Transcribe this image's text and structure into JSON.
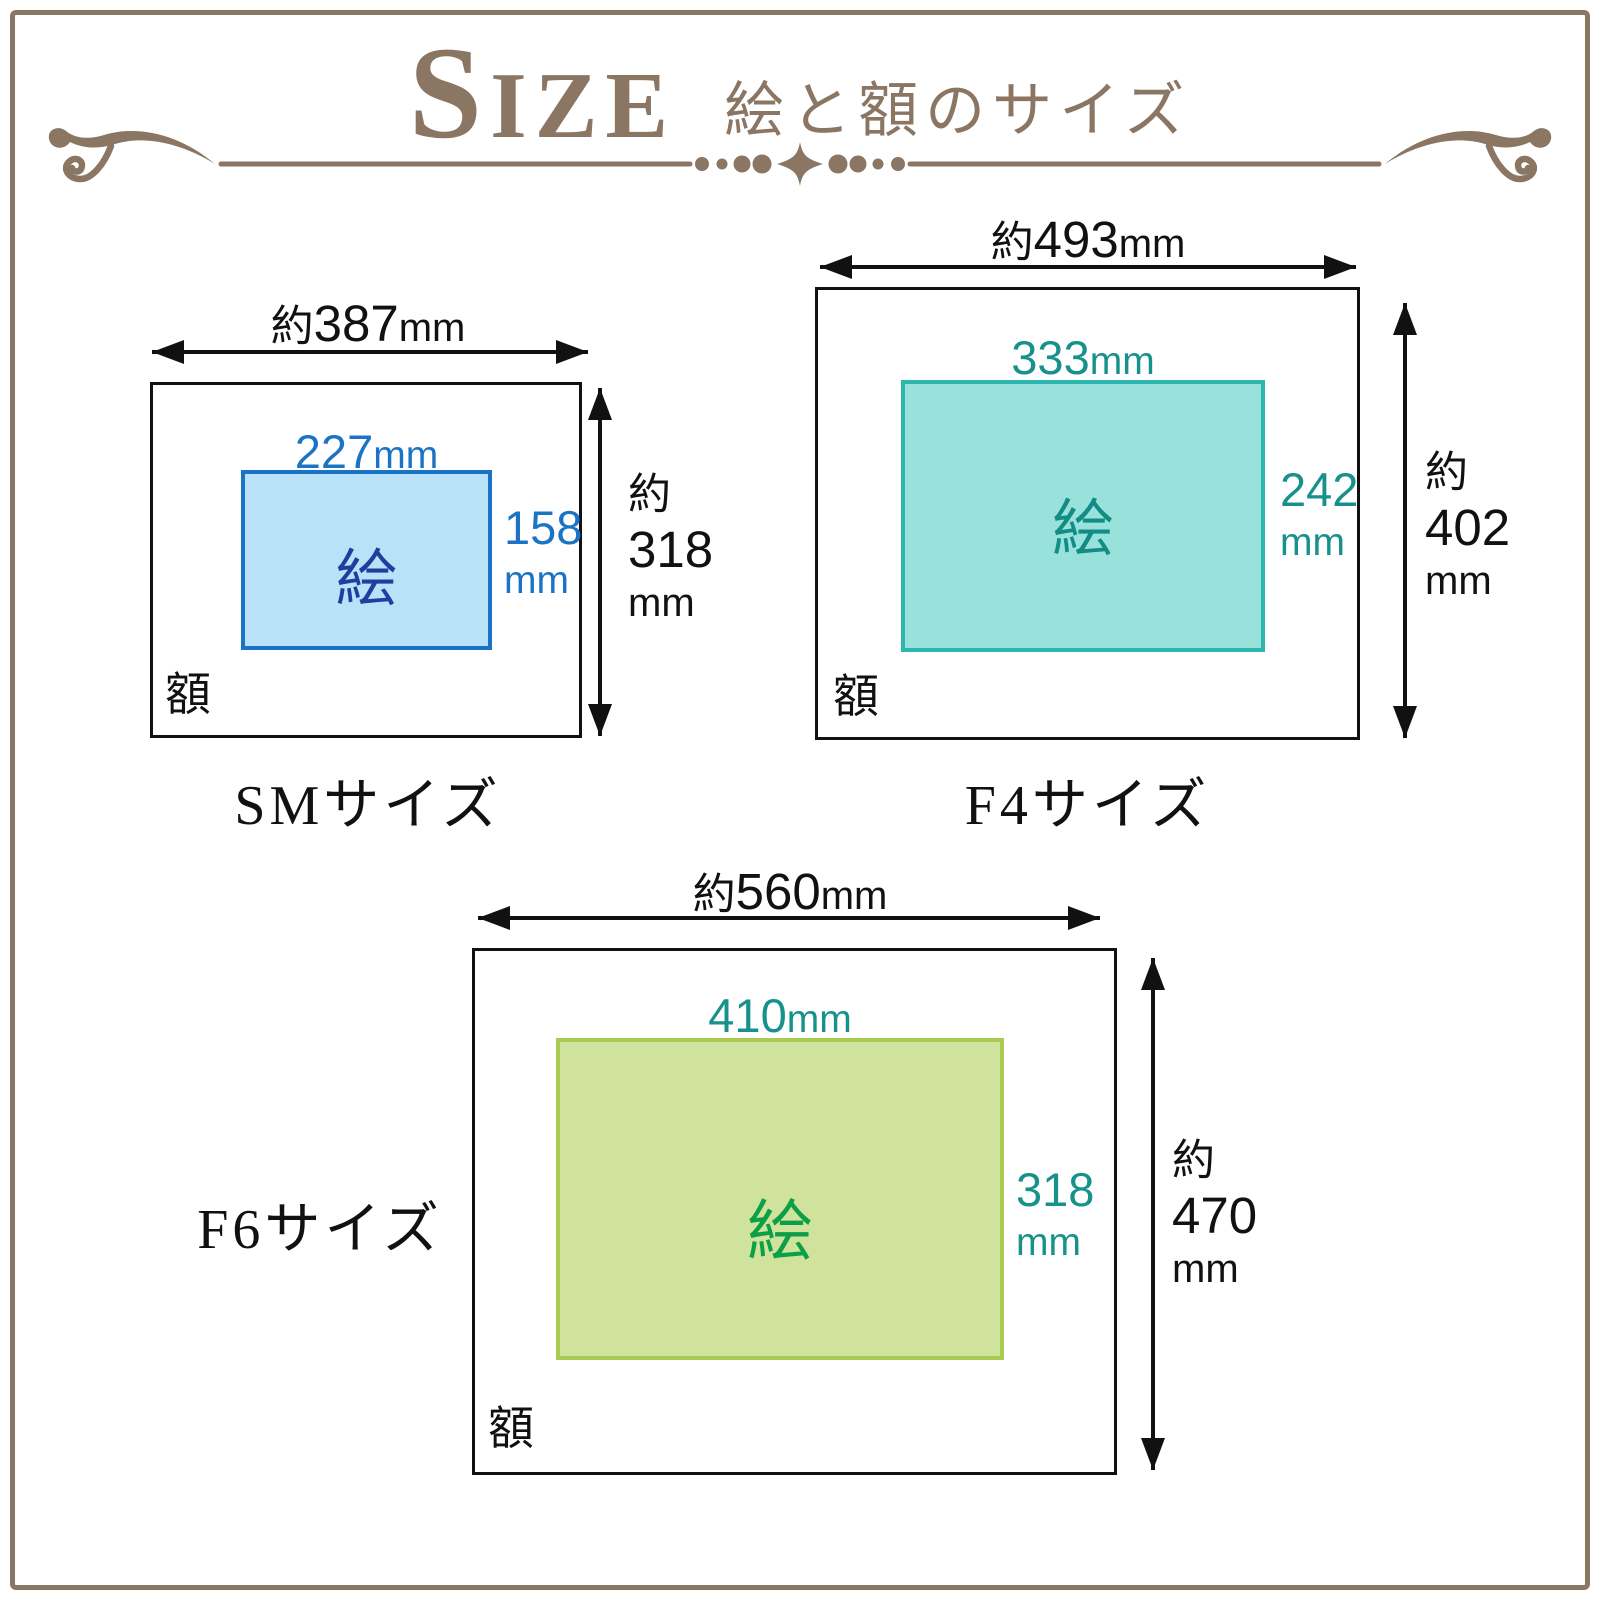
{
  "header": {
    "title_en": "SIZE",
    "title_ja": "絵と額のサイズ",
    "color": "#8a7663"
  },
  "divider": {
    "color": "#8a7663"
  },
  "page": {
    "border_color": "#8a7663"
  },
  "diagrams": [
    {
      "id": "SM",
      "label": "SMサイズ",
      "frame_label": "額",
      "art_label": "絵",
      "frame_width": {
        "prefix": "約",
        "value": "387",
        "unit": "mm"
      },
      "frame_height": {
        "prefix": "約",
        "value": "318",
        "unit": "mm"
      },
      "art_width": {
        "value": "227",
        "unit": "mm"
      },
      "art_height": {
        "value": "158",
        "unit": "mm"
      },
      "colors": {
        "art_fill": "#b9e1f8",
        "art_border": "#1b73c5",
        "dim_text": "#1b73c5",
        "art_text": "#1e3fa0"
      }
    },
    {
      "id": "F4",
      "label": "F4サイズ",
      "frame_label": "額",
      "art_label": "絵",
      "frame_width": {
        "prefix": "約",
        "value": "493",
        "unit": "mm"
      },
      "frame_height": {
        "prefix": "約",
        "value": "402",
        "unit": "mm"
      },
      "art_width": {
        "value": "333",
        "unit": "mm"
      },
      "art_height": {
        "value": "242",
        "unit": "mm"
      },
      "colors": {
        "art_fill": "#98e2db",
        "art_border": "#2cb6ae",
        "dim_text": "#17918b",
        "art_text": "#138c86"
      }
    },
    {
      "id": "F6",
      "label": "F6サイズ",
      "frame_label": "額",
      "art_label": "絵",
      "frame_width": {
        "prefix": "約",
        "value": "560",
        "unit": "mm"
      },
      "frame_height": {
        "prefix": "約",
        "value": "470",
        "unit": "mm"
      },
      "art_width": {
        "value": "410",
        "unit": "mm"
      },
      "art_height": {
        "value": "318",
        "unit": "mm"
      },
      "colors": {
        "art_fill": "#cfe39c",
        "art_border": "#a9cb52",
        "dim_text": "#17918b",
        "art_text": "#0d9f47"
      }
    }
  ]
}
